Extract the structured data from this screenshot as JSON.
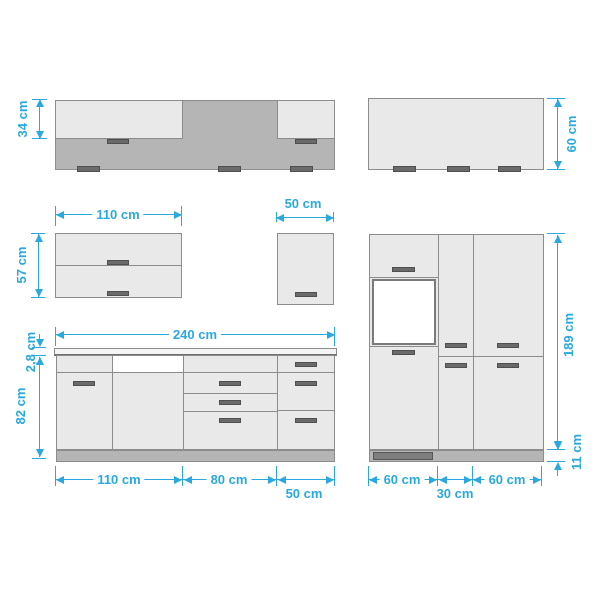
{
  "diagram": {
    "type": "kitchen-cabinet-dimension-drawing",
    "unit": "cm",
    "colors": {
      "dimension": "#29A9E0",
      "cabinet_light": "#E9E9E9",
      "cabinet_mid": "#B5B5B5",
      "outline": "#8C8C8C",
      "handle": "#6A6A6A",
      "niche": "#FFFFFF"
    }
  },
  "dims": {
    "wall_run_height": "34 cm",
    "tall_wall_height": "60 cm",
    "flap_cabinet_width": "110 cm",
    "flap_cabinet_height": "57 cm",
    "wall50_width": "50 cm",
    "base_total_width": "240 cm",
    "worktop_thickness": "2,8 cm",
    "base_height": "82 cm",
    "base_section1": "110 cm",
    "base_section2": "80 cm",
    "base_section3": "50 cm",
    "tall_height": "189 cm",
    "plinth_height": "11 cm",
    "tall_section1": "60 cm",
    "tall_section2": "30 cm",
    "tall_section3": "60 cm"
  }
}
